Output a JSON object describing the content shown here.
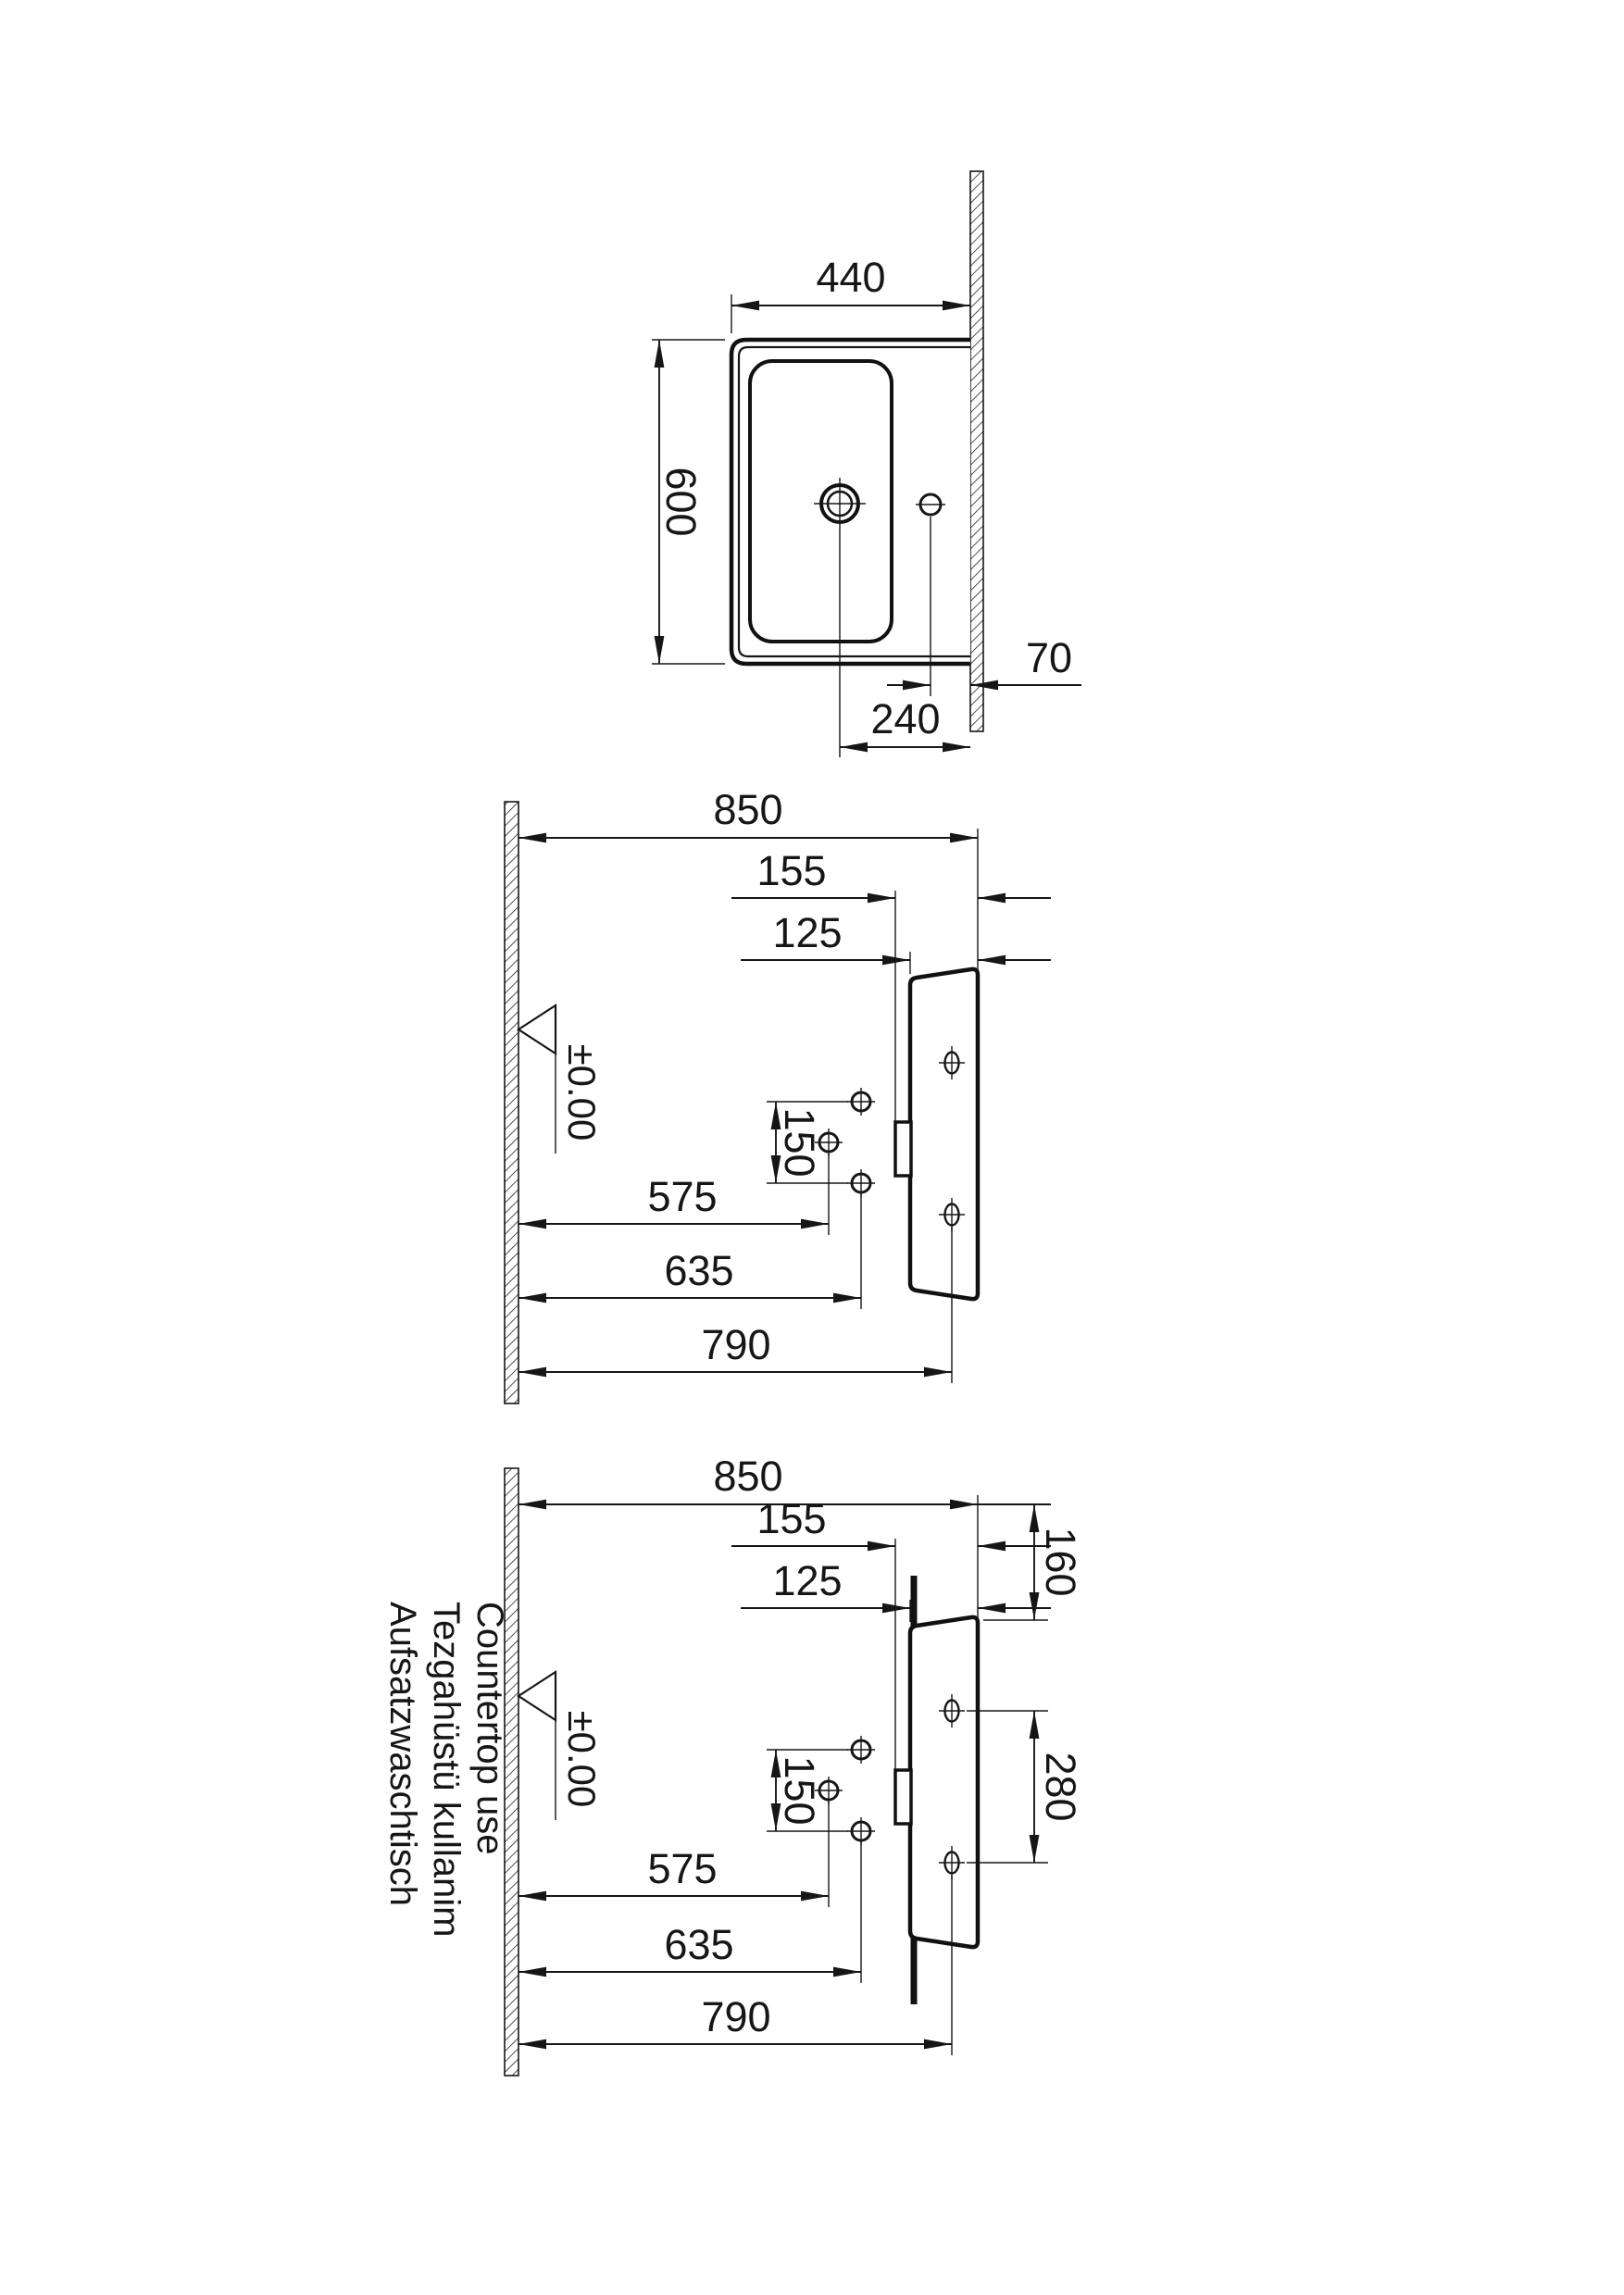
{
  "plan_view": {
    "width": "440",
    "depth": "600",
    "tap_hole_to_wall": "70",
    "waste_to_wall": "240"
  },
  "front_view_wall_hung": {
    "rim_height": "850",
    "drain_fitting_drop": "155",
    "body_thickness": "125",
    "supply_spacing": "150",
    "drain_height": "575",
    "supply_height": "635",
    "fixing_height": "790",
    "level_mark": "±0.00"
  },
  "front_view_countertop": {
    "rim_height": "850",
    "drain_fitting_drop": "155",
    "body_thickness": "125",
    "supply_spacing": "150",
    "drain_height": "575",
    "supply_height": "635",
    "fixing_height": "790",
    "level_mark": "±0.00",
    "rim_to_counter": "160",
    "fixing_spacing": "280",
    "captions": [
      "Countertop use",
      "Tezgahüstü kullanim",
      "Aufsatzwaschtisch"
    ]
  }
}
